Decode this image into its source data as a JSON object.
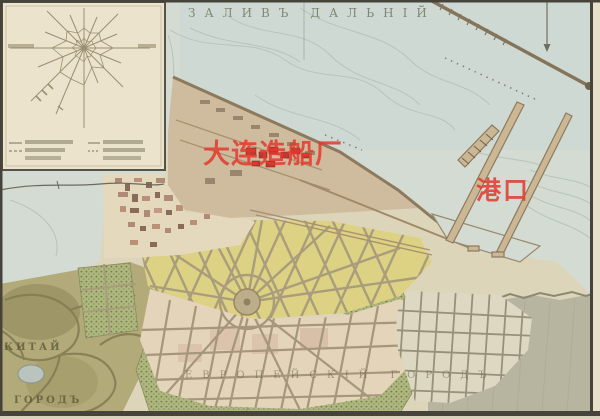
{
  "map": {
    "bay_title": "ЗАЛИВЪ ДАЛЬНІЙ",
    "annotations": {
      "shipyard_label": "大连造船厂",
      "port_label": "港口"
    },
    "district_labels": {
      "chinese_town_line1": "КИТАЙ",
      "chinese_town_line2": "ГОРОДЪ",
      "european_town": "ЕВРОПЕЙСКІЙ ГОРОДЪ"
    },
    "colors": {
      "annotation_red": "#e23a2e",
      "water": "#d3dbd2",
      "paper_margin": "#e7e0c9",
      "inset_paper": "#ebe3cb",
      "yellow_blocks": "#ddd183",
      "cream_blocks": "#e3d4ba",
      "tan_peninsula": "#cfbc9e",
      "olive_terrain": "#b2aa78",
      "park_green": "#aeb77e",
      "slope_grey": "#b7b4a0",
      "shipyard_building_red": "#c0392e"
    }
  }
}
